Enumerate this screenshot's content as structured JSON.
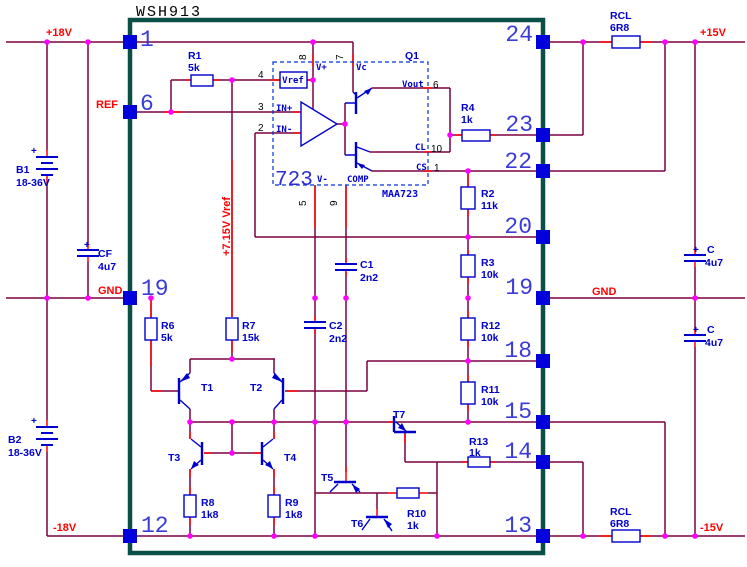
{
  "title": "WSH913",
  "module_pins": {
    "p1": "1",
    "p6": "6",
    "p19_left": "19",
    "p12": "12",
    "p24": "24",
    "p23": "23",
    "p22": "22",
    "p20": "20",
    "p19_right": "19",
    "p18": "18",
    "p15": "15",
    "p14": "14",
    "p13": "13"
  },
  "net_labels": {
    "plus18": "+18V",
    "ref": "REF",
    "gnd_left": "GND",
    "minus18": "-18V",
    "plus15": "+15V",
    "gnd_right": "GND",
    "minus15": "-15V",
    "vref_rail": "+7.15V Vref"
  },
  "ic": {
    "type": "723",
    "part": "MAA723",
    "designator": "Q1",
    "block_vref": "Vref",
    "pin4": "4",
    "pin3": "3",
    "pin2": "2",
    "pin8": "8",
    "pin7": "7",
    "pin6": "6",
    "pin10": "10",
    "pin1": "1",
    "pin5": "5",
    "pin9": "9",
    "vplus": "V+",
    "vc": "Vc",
    "vout": "Vout",
    "cl": "CL",
    "cs": "CS",
    "vminus": "V-",
    "comp": "COMP",
    "in_plus": "IN+",
    "in_minus": "IN-"
  },
  "resistors": {
    "r1": {
      "name": "R1",
      "value": "5k"
    },
    "r2": {
      "name": "R2",
      "value": "11k"
    },
    "r3": {
      "name": "R3",
      "value": "10k"
    },
    "r4": {
      "name": "R4",
      "value": "1k"
    },
    "r6": {
      "name": "R6",
      "value": "5k"
    },
    "r7": {
      "name": "R7",
      "value": "15k"
    },
    "r8": {
      "name": "R8",
      "value": "1k8"
    },
    "r9": {
      "name": "R9",
      "value": "1k8"
    },
    "r10": {
      "name": "R10",
      "value": "1k"
    },
    "r11": {
      "name": "R11",
      "value": "10k"
    },
    "r12": {
      "name": "R12",
      "value": "10k"
    },
    "r13": {
      "name": "R13",
      "value": "1k"
    },
    "rcl_top": {
      "name": "RCL",
      "value": "6R8"
    },
    "rcl_bottom": {
      "name": "RCL",
      "value": "6R8"
    }
  },
  "capacitors": {
    "c1": {
      "name": "C1",
      "value": "2n2"
    },
    "c2": {
      "name": "C2",
      "value": "2n2"
    },
    "cf": {
      "name": "CF",
      "value": "4u7",
      "polarity": "+"
    },
    "c_upper": {
      "name": "C",
      "value": "4u7",
      "polarity": "+"
    },
    "c_lower": {
      "name": "C",
      "value": "4u7",
      "polarity": "+"
    }
  },
  "batteries": {
    "b1": {
      "name": "B1",
      "value": "18-36V",
      "polarity": "+"
    },
    "b2": {
      "name": "B2",
      "value": "18-36V",
      "polarity": "+"
    }
  },
  "transistors": {
    "t1": "T1",
    "t2": "T2",
    "t3": "T3",
    "t4": "T4",
    "t5": "T5",
    "t6": "T6",
    "t7": "T7"
  },
  "colors": {
    "wire": "#7a0040",
    "terminal": "#ff0000",
    "symbol": "#0000cd",
    "junction": "#ff00ff",
    "module_border": "#0a4f45",
    "pin_square": "#0000dd",
    "net_text": "#ff0000",
    "pin_text": "#3b3bd8",
    "title_text": "#000000"
  }
}
